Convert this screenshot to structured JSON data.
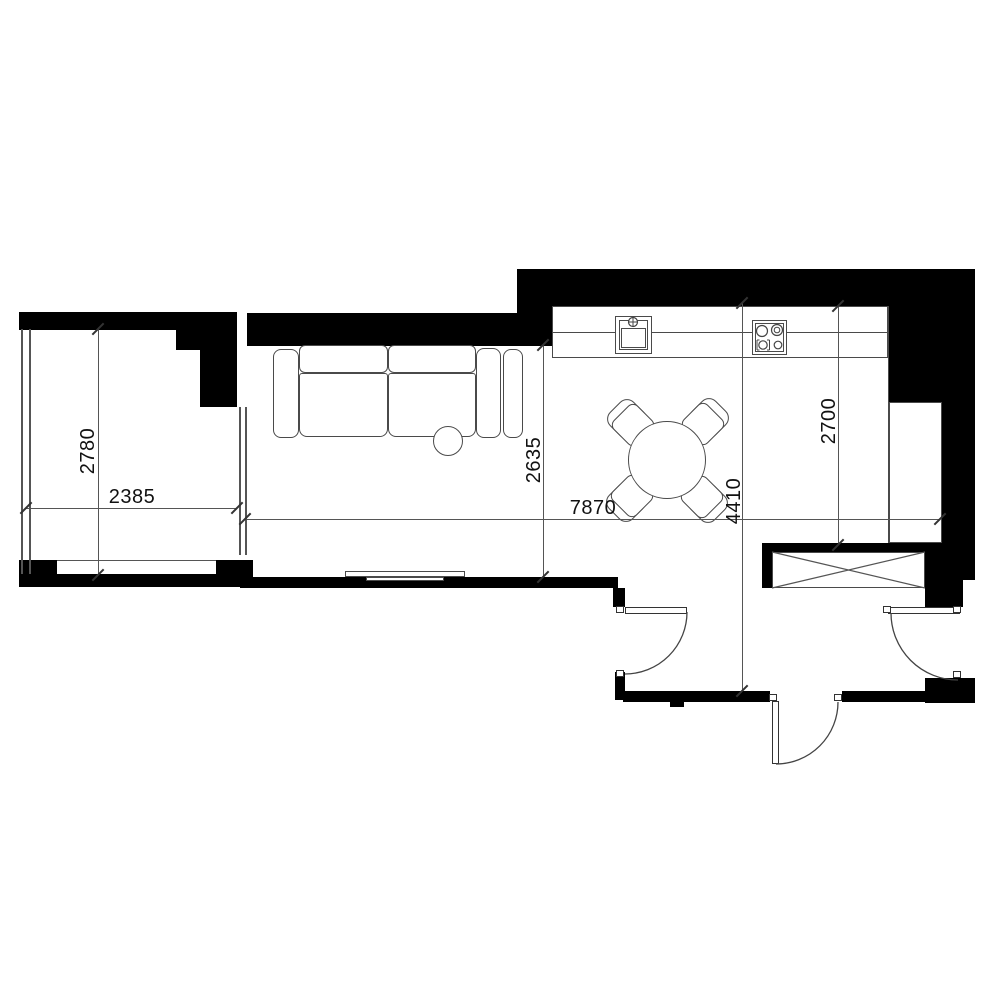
{
  "plan": {
    "type": "apartment-floor-plan",
    "dimensions": {
      "balcony_height": {
        "value": "2780"
      },
      "balcony_width": {
        "value": "2385"
      },
      "living_height": {
        "value": "2635"
      },
      "main_width": {
        "value": "7870"
      },
      "right_wing_height": {
        "value": "4410"
      },
      "kitchen_height": {
        "value": "2700"
      }
    },
    "furniture": [
      "sofa",
      "round-cushion",
      "tv-console",
      "dining-table",
      "dining-chair",
      "kitchen-counter",
      "sink",
      "cooktop",
      "ventilation-shaft",
      "swing-door"
    ],
    "colors": {
      "wall": "#000000",
      "line": "#4a4a4a",
      "dimline": "#555555",
      "floor": "#ffffff",
      "text": "#111111"
    }
  }
}
